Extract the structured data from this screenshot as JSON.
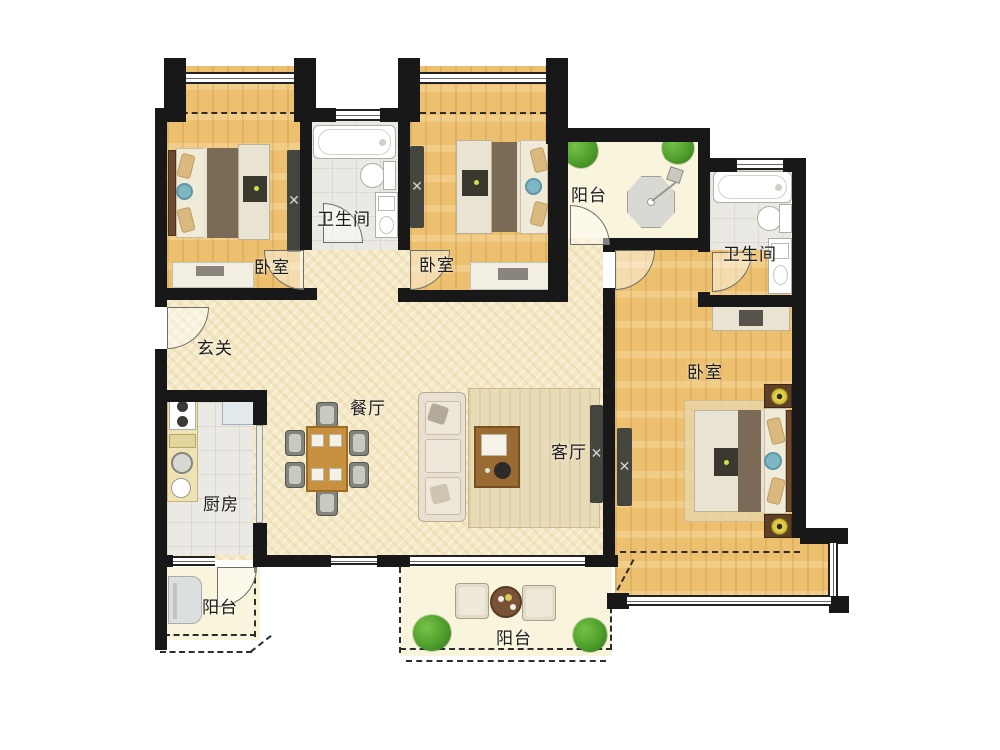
{
  "labels": {
    "bedroom_top_left": "卧室",
    "bedroom_top_middle": "卧室",
    "bedroom_master": "卧室",
    "bathroom_top": "卫生间",
    "bathroom_right": "卫生间",
    "balcony_top": "阳台",
    "balcony_bottom_left": "阳台",
    "balcony_bottom_center": "阳台",
    "entry_hall": "玄关",
    "dining_room": "餐厅",
    "kitchen": "厨房",
    "living_room": "客厅"
  },
  "colors": {
    "wall": "#181818",
    "wood_floor": "#ecc06f",
    "hall_floor": "#f4e8c5",
    "tile_floor": "#ebe9e4",
    "balcony_floor": "#f9f5dd",
    "plant_green": "#4f9e2c",
    "duvet_brown": "#7b6a55",
    "table_wood": "#c8913f"
  }
}
